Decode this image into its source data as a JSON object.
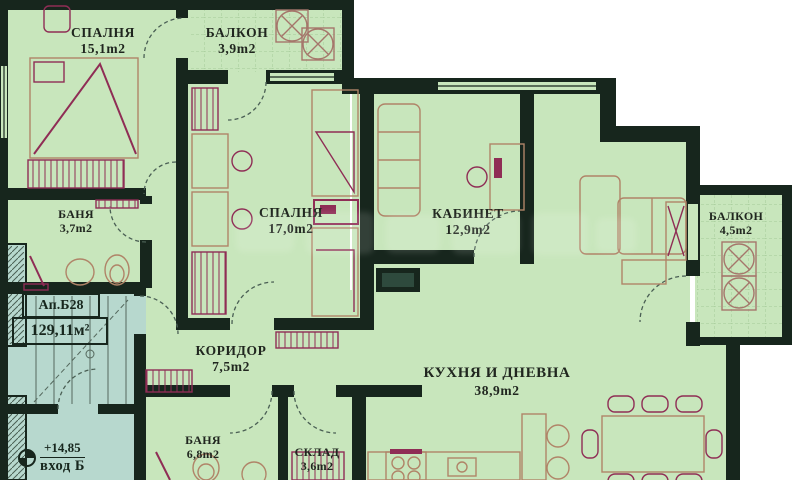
{
  "plan": {
    "apartment_label": "Ап.Б28",
    "apartment_area": "129,11м²",
    "entrance_level": "+14,85",
    "entrance_label": "вход Б",
    "rooms": {
      "bedroom1": {
        "name": "СПАЛНЯ",
        "area": "15,1m2"
      },
      "balcony1": {
        "name": "БАЛКОН",
        "area": "3,9m2"
      },
      "bath1": {
        "name": "БАНЯ",
        "area": "3,7m2"
      },
      "bedroom2": {
        "name": "СПАЛНЯ",
        "area": "17,0m2"
      },
      "office": {
        "name": "КАБИНЕТ",
        "area": "12,9m2"
      },
      "balcony2": {
        "name": "БАЛКОН",
        "area": "4,5m2"
      },
      "corridor": {
        "name": "КОРИДОР",
        "area": "7,5m2"
      },
      "living": {
        "name": "КУХНЯ И ДНЕВНА",
        "area": "38,9m2"
      },
      "bath2": {
        "name": "БАНЯ",
        "area": "6,8m2"
      },
      "storage": {
        "name": "СКЛАД",
        "area": "3,6m2"
      }
    },
    "colors": {
      "floor": "#c8e6bc",
      "common_area": "#b7d8ce",
      "wall": "#17261d",
      "furniture_maroon": "#8f2d55",
      "furniture_brown": "#b08468"
    }
  }
}
